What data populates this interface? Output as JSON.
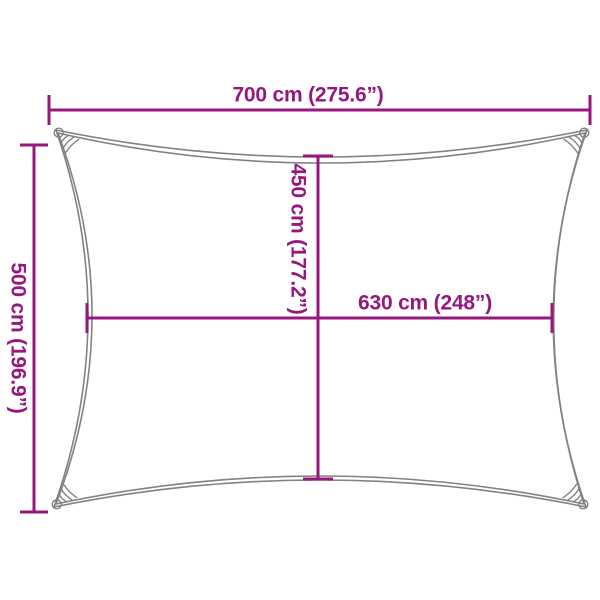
{
  "diagram": {
    "kind": "product-dimension-diagram",
    "subject": "rectangular shade sail with concave edges",
    "colors": {
      "dimension_accent": "#97177f",
      "outline_gray": "#828282",
      "background": "#ffffff"
    },
    "dimensions": {
      "top_width": {
        "label": "700 cm (275.6”)",
        "value_cm": 700,
        "value_in": 275.6
      },
      "left_height": {
        "label": "500 cm (196.9”)",
        "value_cm": 500,
        "value_in": 196.9
      },
      "inner_height": {
        "label": "450 cm (177.2”)",
        "value_cm": 450,
        "value_in": 177.2
      },
      "inner_width": {
        "label": "630 cm (248”)",
        "value_cm": 630,
        "value_in": 248
      }
    }
  }
}
